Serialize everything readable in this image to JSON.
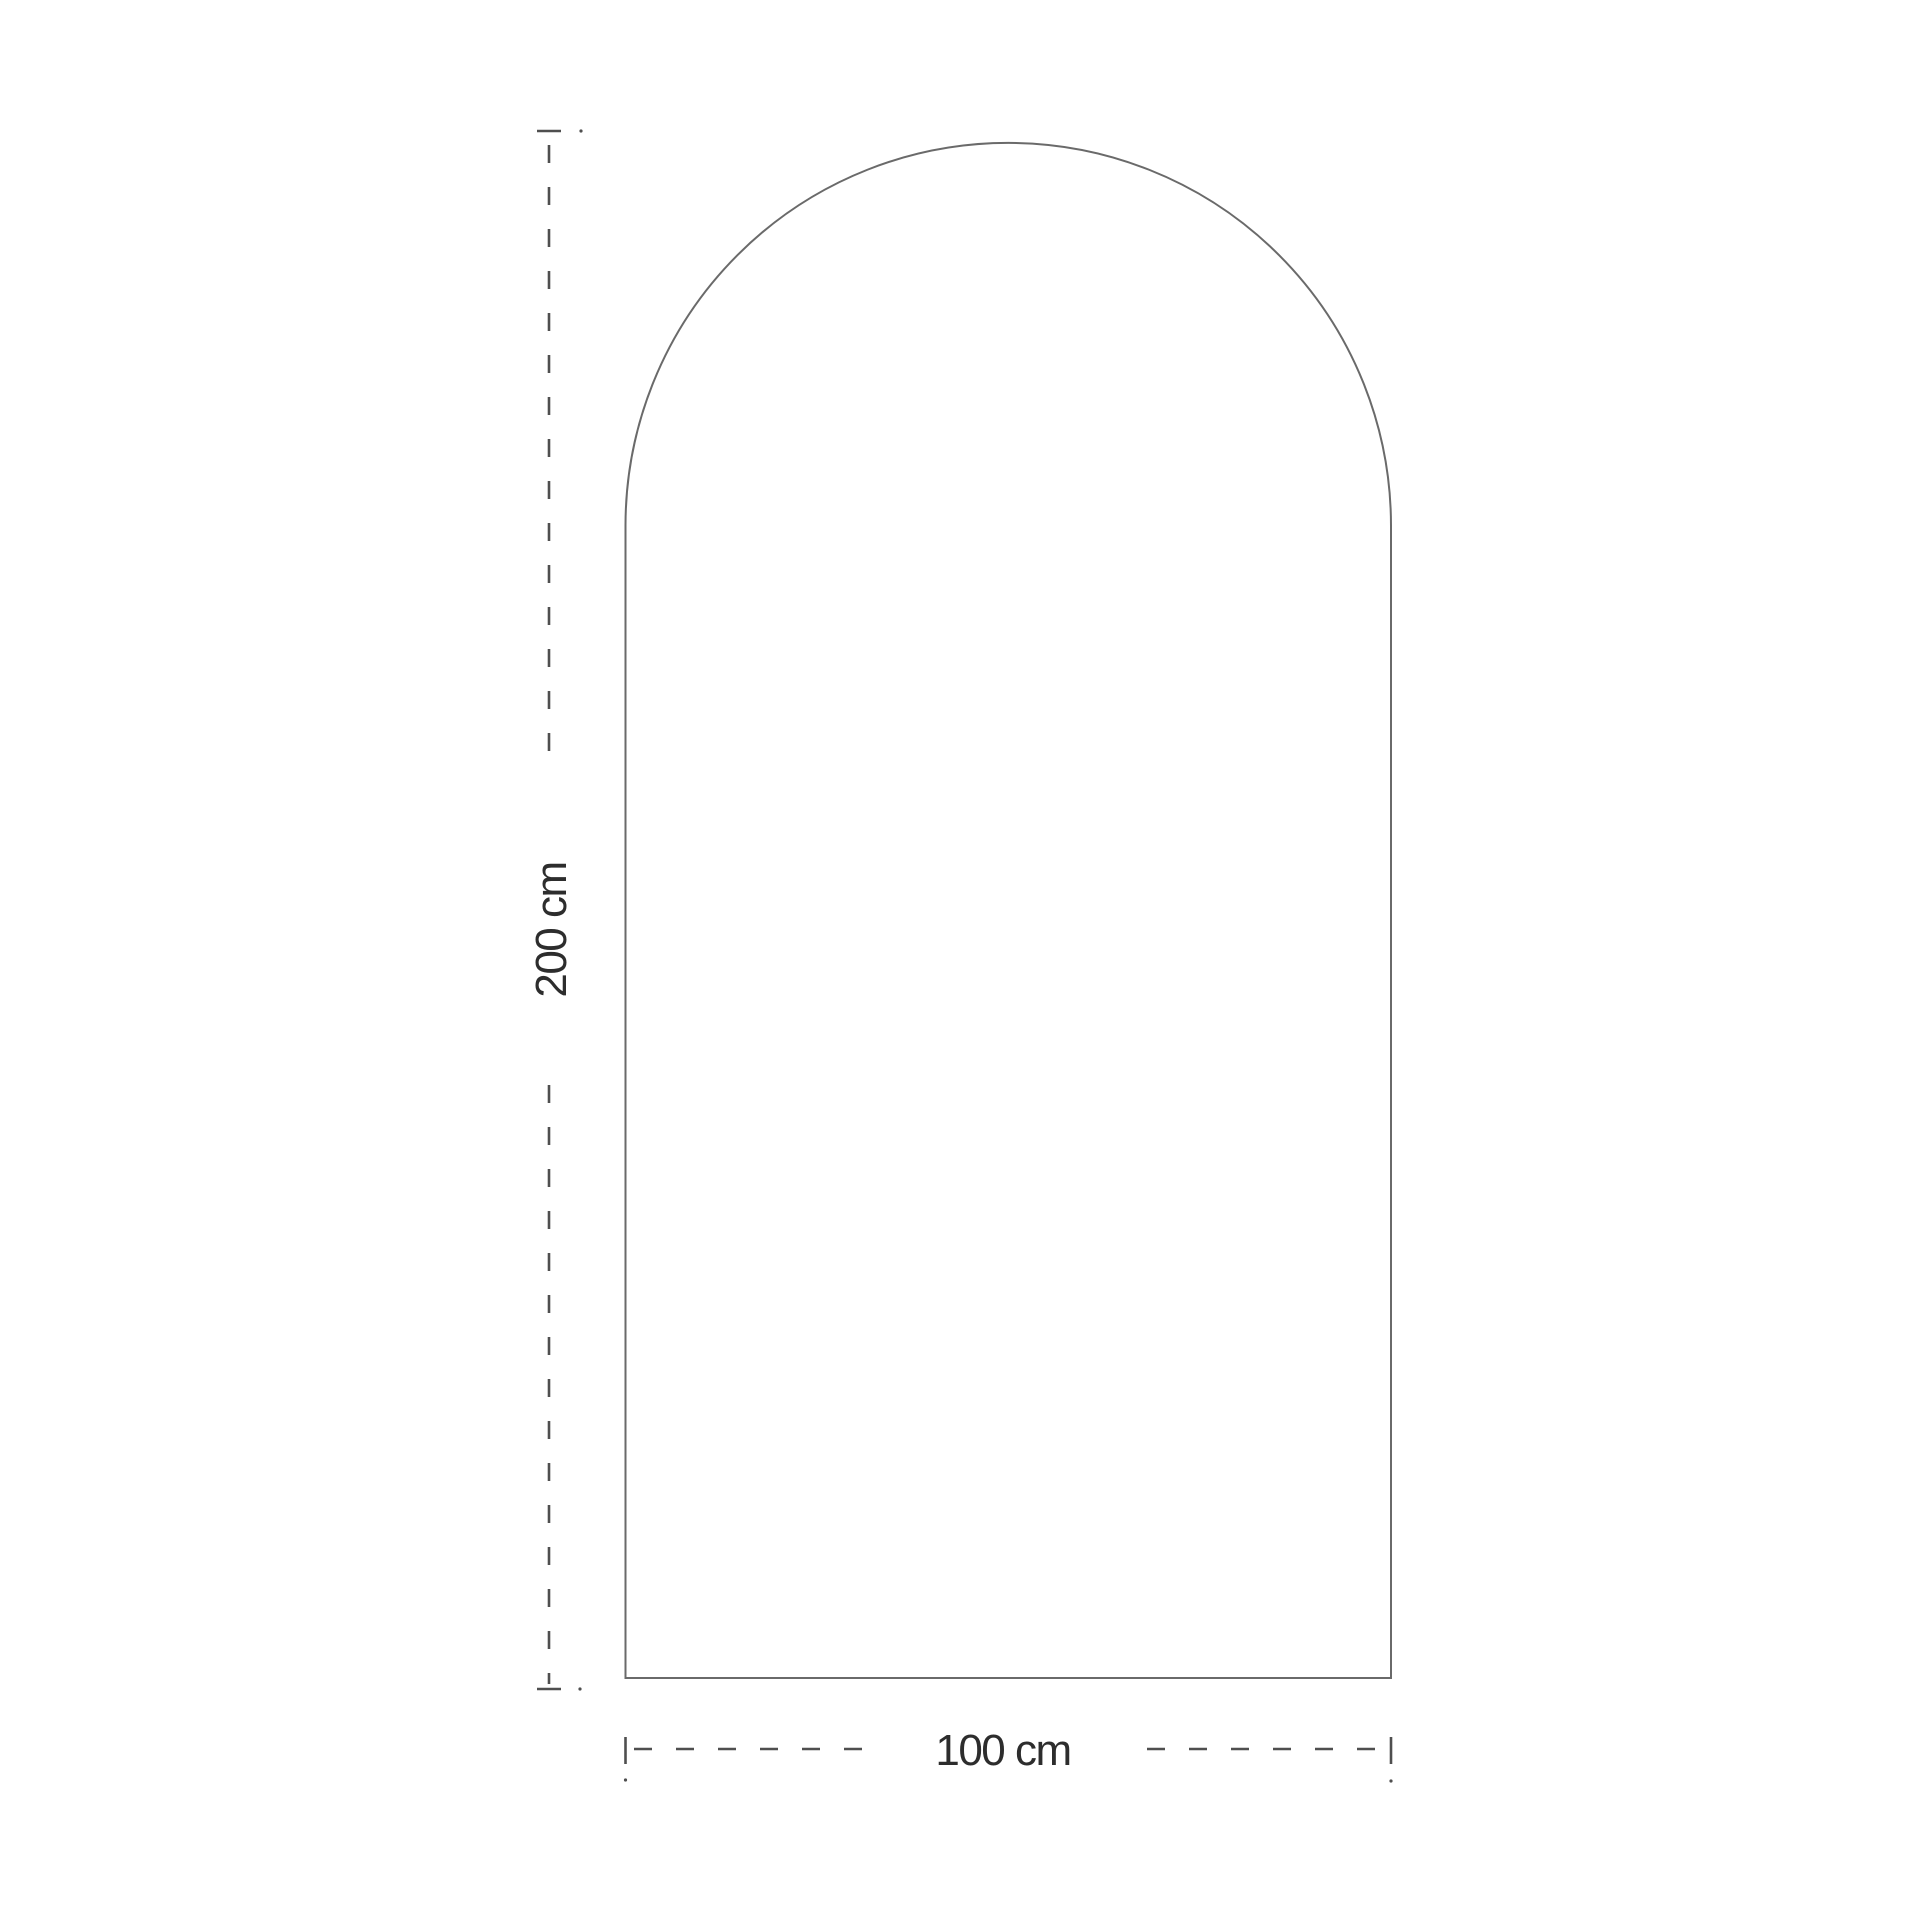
{
  "page": {
    "background": "#ffffff",
    "description": "Technical dimension drawing of an arched panel (round-top arch outline) with dashed dimension lines"
  },
  "diagram": {
    "shape": {
      "name": "arched-panel",
      "outline_style": "thin solid",
      "fill": "#ffffff"
    },
    "height_dimension": {
      "label": "200 cm",
      "value_cm": 200,
      "orientation": "vertical",
      "line_style": "dashed with end ticks"
    },
    "width_dimension": {
      "label": "100 cm",
      "value_cm": 100,
      "orientation": "horizontal",
      "line_style": "dashed with end ticks"
    },
    "colors": {
      "outline": "#6a6a6a",
      "dimension_line": "#4f4f4f",
      "text": "#2d2d2d",
      "background": "#ffffff"
    }
  }
}
